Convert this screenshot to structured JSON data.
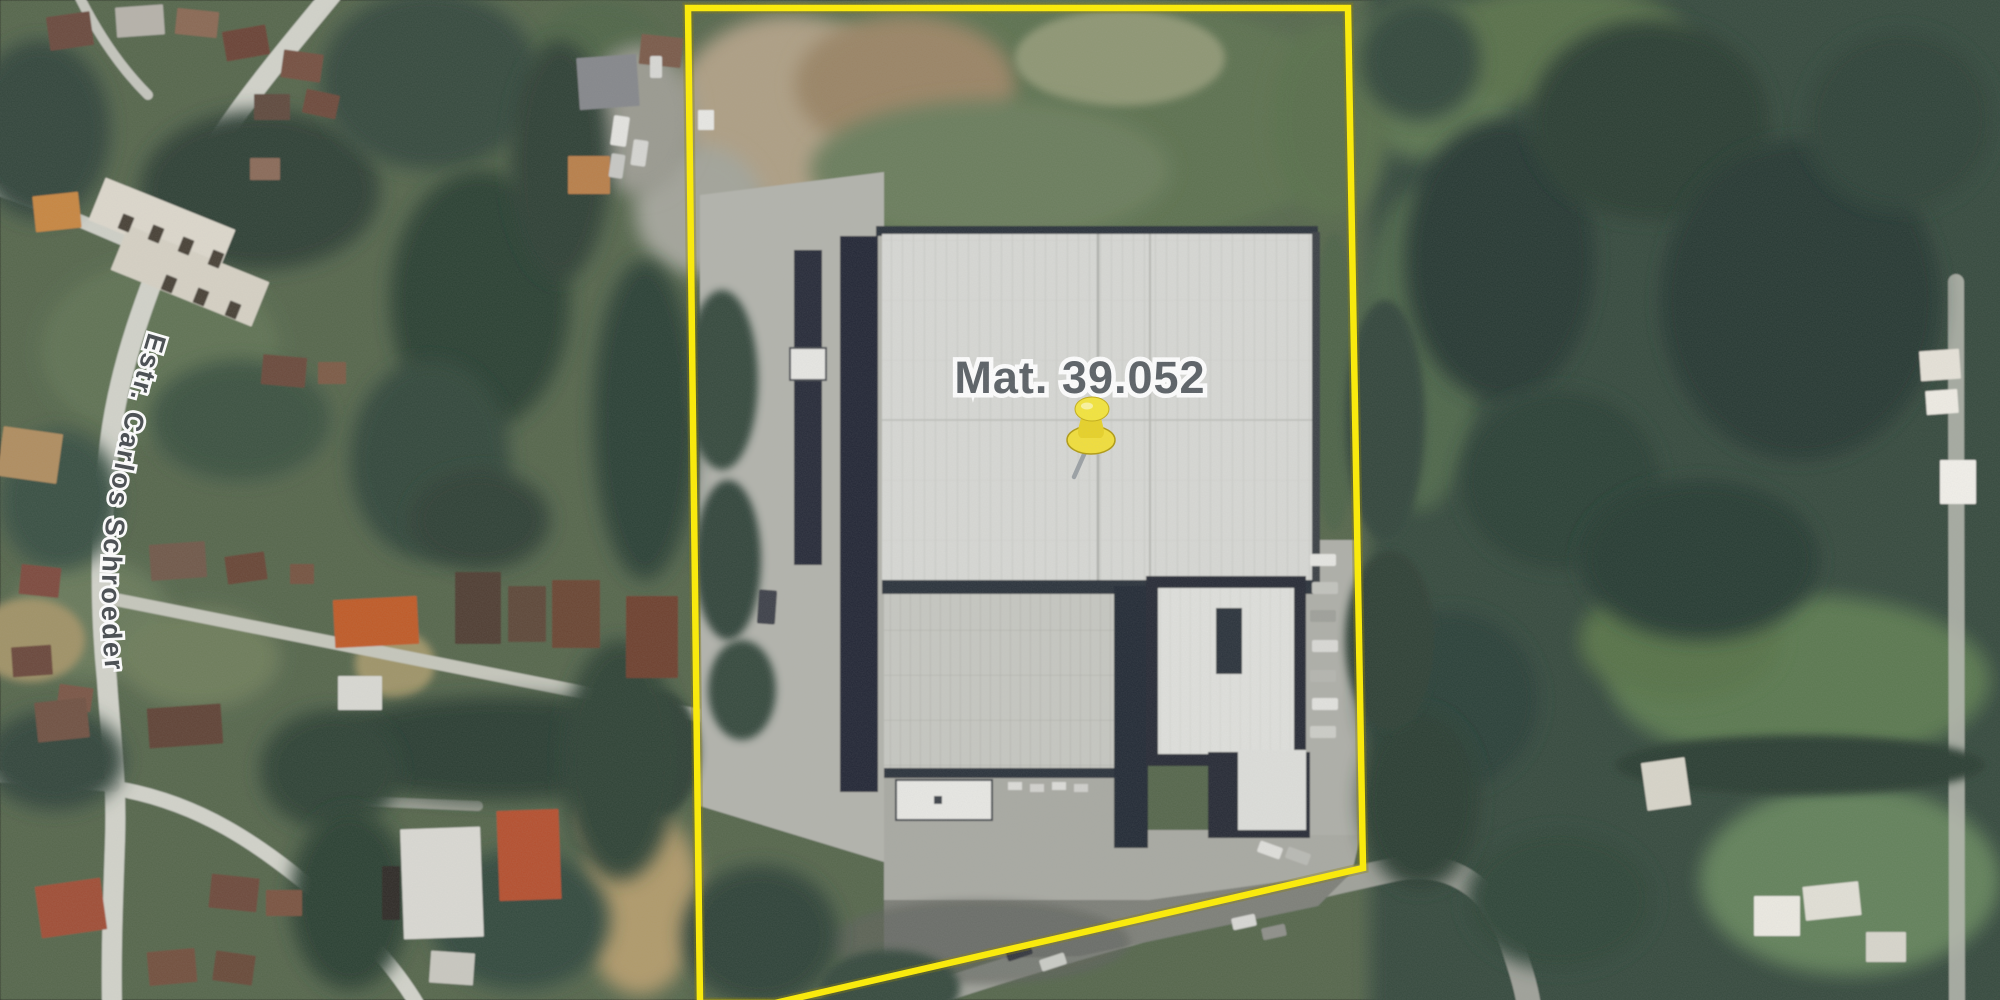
{
  "map": {
    "type": "satellite-aerial-view",
    "parcel_label": "Mat. 39.052",
    "street_label": "Estr. Carlos Schroeder",
    "marker": {
      "kind": "pushpin",
      "color": "#f2df3a",
      "needle_color": "#9aa0a4"
    },
    "boundary": {
      "color": "#ffee00",
      "points": "688,8 1348,8 1363,868 775,1003 700,1003"
    }
  },
  "colors": {
    "suburb_base": "#55664c",
    "forest_base": "#36493c",
    "pavement": "#b2b3ac",
    "roof_light": "#d7d8d4",
    "roof_dark_edge": "#2b303a"
  },
  "scenery": {
    "ground_patches": [
      [
        160,
        350,
        120,
        90,
        "#5f7252"
      ],
      [
        90,
        618,
        80,
        60,
        "#68795a"
      ],
      [
        200,
        658,
        80,
        50,
        "#6d7c5a"
      ],
      [
        30,
        640,
        55,
        42,
        "#a09266"
      ],
      [
        395,
        664,
        40,
        34,
        "#9f9468"
      ],
      [
        1430,
        80,
        85,
        80,
        "#5c7451"
      ],
      [
        1560,
        45,
        130,
        60,
        "#587049"
      ],
      [
        1800,
        680,
        190,
        85,
        "#5a7850"
      ],
      [
        1850,
        880,
        150,
        95,
        "#62815a"
      ],
      [
        1680,
        640,
        100,
        60,
        "#567246"
      ],
      [
        1040,
        120,
        330,
        130,
        "#5b7150"
      ],
      [
        1330,
        120,
        60,
        100,
        "#586e4c"
      ],
      [
        600,
        58,
        70,
        60,
        "#4f6547"
      ],
      [
        790,
        110,
        115,
        95,
        "#ae9f84"
      ],
      [
        905,
        85,
        110,
        70,
        "#9a8465"
      ],
      [
        1120,
        58,
        105,
        48,
        "#8e9673"
      ],
      [
        700,
        210,
        65,
        65,
        "#a3a49a"
      ],
      [
        640,
        120,
        55,
        75,
        "#9a9a90"
      ],
      [
        990,
        170,
        180,
        70,
        "#6b7d5c"
      ],
      [
        1420,
        350,
        60,
        160,
        "#4d6649"
      ],
      [
        640,
        900,
        60,
        95,
        "#b09a6a"
      ],
      [
        616,
        820,
        42,
        40,
        "#a8946a"
      ]
    ],
    "roads": [
      {
        "d": "M 332,-6 C 275,64 205,144 176,221 C 148,291 120,361 110,441 C 100,521 99,601 107,681 C 111,741 117,781 115,841 C 113,901 111,951 112,1006",
        "w": 20,
        "c": "#d2d3ca"
      },
      {
        "d": "M -6,188 C 55,208 118,238 168,258",
        "w": 13,
        "c": "#cfd0c7"
      },
      {
        "d": "M 114,788 C 198,802 258,842 328,902 C 368,937 398,972 418,1006",
        "w": 15,
        "c": "#d2d3ca"
      },
      {
        "d": "M 114,786 L -6,776",
        "w": 12,
        "c": "#c8c9c0"
      },
      {
        "d": "M 78,-6 Q 108,55 148,95",
        "w": 10,
        "c": "#c4c5bc"
      },
      {
        "d": "M 1956,282 L 1957,1006",
        "w": 16,
        "c": "#b9bbb2",
        "o": 0.85
      },
      {
        "d": "M 895,1006 C 1095,938 1255,900 1392,870 C 1448,858 1492,884 1512,944 C 1520,968 1526,986 1529,1006",
        "w": 24,
        "c": "#9fa199"
      },
      {
        "d": "M 108,598 C 260,628 460,668 702,716",
        "w": 13,
        "c": "#c6c7bc"
      },
      {
        "d": "M 332,800 L 478,806",
        "w": 10,
        "c": "#a8a9a0",
        "o": 0.85
      }
    ],
    "tree_patches": [
      [
        40,
        130,
        70,
        90,
        "#31453a"
      ],
      [
        260,
        190,
        120,
        80,
        "#2e4135"
      ],
      [
        430,
        80,
        110,
        90,
        "#354a3c"
      ],
      [
        480,
        300,
        90,
        130,
        "#2c3f33"
      ],
      [
        430,
        460,
        80,
        100,
        "#31463a"
      ],
      [
        480,
        520,
        70,
        50,
        "#2d4034"
      ],
      [
        500,
        748,
        185,
        52,
        "#2b3e32"
      ],
      [
        660,
        752,
        40,
        62,
        "#2e4136"
      ],
      [
        240,
        420,
        90,
        60,
        "#3b5140"
      ],
      [
        60,
        500,
        60,
        70,
        "#375043"
      ],
      [
        55,
        760,
        70,
        50,
        "#30443a"
      ],
      [
        330,
        770,
        70,
        60,
        "#2f4336"
      ],
      [
        560,
        160,
        50,
        120,
        "#2e4136"
      ],
      [
        645,
        420,
        52,
        160,
        "#2c3f34"
      ],
      [
        620,
        760,
        58,
        120,
        "#2e4236"
      ],
      [
        520,
        920,
        90,
        70,
        "#33483c"
      ],
      [
        350,
        900,
        60,
        90,
        "#2c3f33"
      ],
      [
        722,
        380,
        36,
        90,
        "#35493c"
      ],
      [
        728,
        560,
        33,
        80,
        "#31453a"
      ],
      [
        742,
        690,
        34,
        50,
        "#36493d"
      ],
      [
        760,
        935,
        78,
        70,
        "#2f4337"
      ],
      [
        890,
        988,
        70,
        38,
        "#35483c"
      ],
      [
        1334,
        382,
        24,
        150,
        "#4e6347"
      ],
      [
        1500,
        260,
        95,
        140,
        "#263830"
      ],
      [
        1650,
        120,
        120,
        100,
        "#2a3d33"
      ],
      [
        1800,
        300,
        140,
        160,
        "#253731"
      ],
      [
        1560,
        480,
        100,
        90,
        "#2c4036"
      ],
      [
        1700,
        560,
        120,
        80,
        "#283b31"
      ],
      [
        1450,
        700,
        90,
        90,
        "#2c4037"
      ],
      [
        1560,
        900,
        95,
        70,
        "#2f4438"
      ],
      [
        1900,
        120,
        95,
        90,
        "#2e4237"
      ],
      [
        1420,
        60,
        60,
        60,
        "#33473b"
      ],
      [
        1800,
        765,
        185,
        30,
        "#2a3d31"
      ],
      [
        1420,
        800,
        60,
        90,
        "#293c31"
      ],
      [
        1385,
        420,
        40,
        120,
        "#31453a"
      ],
      [
        1390,
        640,
        45,
        90,
        "#2d4135"
      ]
    ],
    "houses": [
      [
        48,
        14,
        44,
        34,
        "#6a4a3c",
        -8
      ],
      [
        116,
        6,
        48,
        30,
        "#b6b2aa",
        -4
      ],
      [
        176,
        10,
        42,
        26,
        "#8a6752",
        6
      ],
      [
        224,
        28,
        44,
        30,
        "#6b4336",
        -10
      ],
      [
        282,
        52,
        40,
        28,
        "#74503f",
        8
      ],
      [
        304,
        92,
        34,
        24,
        "#6d4a3a",
        12
      ],
      [
        254,
        94,
        36,
        26,
        "#5f4a3e",
        0
      ],
      [
        250,
        158,
        30,
        22,
        "#8a6a58",
        0
      ],
      [
        34,
        194,
        46,
        36,
        "#c8863f",
        -6
      ],
      [
        92,
        202,
        140,
        46,
        "#ddd8cc",
        22
      ],
      [
        114,
        252,
        152,
        48,
        "#d6d1c4",
        22
      ],
      [
        120,
        215,
        12,
        16,
        "#473f36",
        22
      ],
      [
        150,
        226,
        12,
        16,
        "#473f36",
        22
      ],
      [
        180,
        238,
        12,
        16,
        "#473f36",
        22
      ],
      [
        210,
        251,
        12,
        16,
        "#473f36",
        22
      ],
      [
        163,
        276,
        12,
        16,
        "#473f36",
        22
      ],
      [
        195,
        289,
        12,
        16,
        "#473f36",
        22
      ],
      [
        227,
        302,
        12,
        16,
        "#473f36",
        22
      ],
      [
        578,
        56,
        60,
        52,
        "#85878b",
        -4
      ],
      [
        640,
        36,
        42,
        30,
        "#7a5a48",
        6
      ],
      [
        568,
        156,
        42,
        38,
        "#b97f4a",
        0
      ],
      [
        0,
        430,
        60,
        50,
        "#b08d5f",
        8
      ],
      [
        262,
        356,
        44,
        30,
        "#6b4a3a",
        5
      ],
      [
        318,
        362,
        28,
        22,
        "#7c5a45",
        0
      ],
      [
        150,
        543,
        56,
        36,
        "#6f5848",
        -4
      ],
      [
        20,
        566,
        40,
        30,
        "#7d4a3c",
        6
      ],
      [
        226,
        554,
        40,
        28,
        "#684536",
        -8
      ],
      [
        290,
        564,
        24,
        20,
        "#75523f",
        0
      ],
      [
        12,
        646,
        40,
        30,
        "#6b473a",
        -4
      ],
      [
        58,
        686,
        34,
        24,
        "#7a5544",
        8
      ],
      [
        334,
        598,
        84,
        48,
        "#c05a28",
        -3
      ],
      [
        455,
        572,
        46,
        72,
        "#4f3c30",
        0
      ],
      [
        508,
        586,
        38,
        56,
        "#5d4738",
        0
      ],
      [
        552,
        580,
        48,
        68,
        "#6b4530",
        0
      ],
      [
        626,
        596,
        52,
        82,
        "#6e3f2e",
        0
      ],
      [
        338,
        676,
        44,
        34,
        "#d9d9d3",
        0
      ],
      [
        36,
        700,
        52,
        40,
        "#6f5142",
        -6
      ],
      [
        148,
        706,
        74,
        40,
        "#5f4334",
        -4
      ],
      [
        38,
        882,
        66,
        52,
        "#a04e36",
        -8
      ],
      [
        210,
        876,
        48,
        34,
        "#6d4a3a",
        6
      ],
      [
        266,
        890,
        36,
        26,
        "#7a5240",
        0
      ],
      [
        148,
        950,
        48,
        34,
        "#72503e",
        -5
      ],
      [
        214,
        953,
        40,
        30,
        "#684839",
        8
      ],
      [
        402,
        828,
        80,
        110,
        "#dad9d3",
        -2
      ],
      [
        382,
        866,
        18,
        54,
        "#2f2b26",
        0
      ],
      [
        498,
        810,
        62,
        90,
        "#b5502f",
        -2
      ],
      [
        430,
        952,
        44,
        32,
        "#c9c8c0",
        4
      ],
      [
        1920,
        350,
        40,
        30,
        "#e6e2d8",
        -4
      ],
      [
        1926,
        390,
        32,
        24,
        "#efece4",
        -4
      ],
      [
        1940,
        460,
        36,
        44,
        "#f2f0ea",
        0
      ],
      [
        1754,
        896,
        46,
        40,
        "#eceae2",
        0
      ],
      [
        1804,
        884,
        56,
        34,
        "#e2e0d6",
        -6
      ],
      [
        1866,
        932,
        40,
        30,
        "#d8d6cc",
        0
      ],
      [
        1644,
        760,
        44,
        48,
        "#d8d5c9",
        -8
      ],
      [
        698,
        110,
        16,
        20,
        "#e8e8e4",
        0
      ]
    ],
    "cars": [
      [
        1310,
        554,
        26,
        12,
        "#e6e6e2",
        0
      ],
      [
        1312,
        582,
        26,
        12,
        "#c2c3bd",
        0
      ],
      [
        1310,
        610,
        26,
        12,
        "#9fa09a",
        0
      ],
      [
        1312,
        640,
        26,
        12,
        "#d9d9d5",
        0
      ],
      [
        1310,
        670,
        26,
        12,
        "#b4b5af",
        0
      ],
      [
        1312,
        698,
        26,
        12,
        "#e2e2de",
        0
      ],
      [
        1310,
        726,
        26,
        12,
        "#cccdc7",
        0
      ],
      [
        1258,
        844,
        24,
        12,
        "#dfdfdb",
        20
      ],
      [
        1286,
        850,
        24,
        12,
        "#b9bab4",
        20
      ],
      [
        1006,
        946,
        26,
        12,
        "#32363c",
        -18
      ],
      [
        1040,
        956,
        26,
        12,
        "#caccc6",
        -18
      ],
      [
        1232,
        916,
        24,
        12,
        "#d8d8d4",
        -12
      ],
      [
        1262,
        926,
        24,
        12,
        "#8e8f89",
        -12
      ],
      [
        612,
        116,
        16,
        30,
        "#e4e4e0",
        8
      ],
      [
        632,
        140,
        15,
        26,
        "#d6d6d2",
        8
      ],
      [
        610,
        154,
        14,
        24,
        "#c8c8c4",
        8
      ],
      [
        650,
        56,
        12,
        22,
        "#d8d8d4",
        0
      ],
      [
        758,
        590,
        18,
        34,
        "#3c4148",
        4
      ]
    ]
  }
}
